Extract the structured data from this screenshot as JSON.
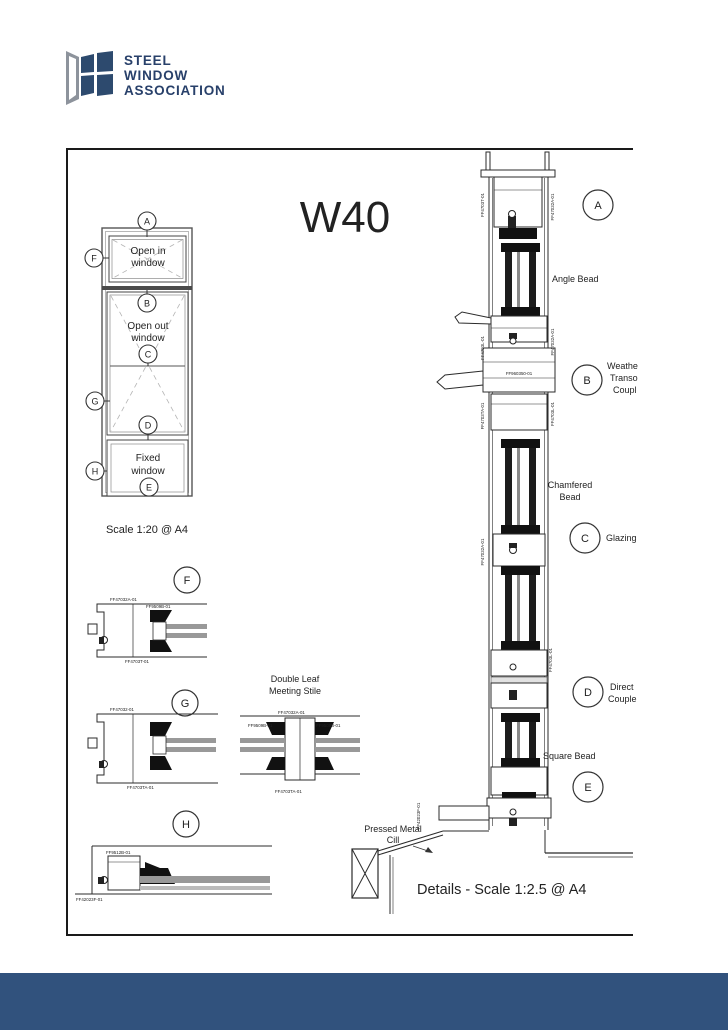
{
  "logo": {
    "line1": "STEEL",
    "line2": "WINDOW",
    "line3": "ASSOCIATION"
  },
  "sheet": {
    "title": "W40",
    "elevation": {
      "open_in_1": "Open in",
      "open_in_2": "window",
      "open_out_1": "Open out",
      "open_out_2": "window",
      "fixed_1": "Fixed",
      "fixed_2": "window",
      "scale": "Scale 1:20 @ A4"
    },
    "markers": {
      "a": "A",
      "b": "B",
      "c": "C",
      "d": "D",
      "e": "E",
      "f": "F",
      "g": "G",
      "h": "H"
    },
    "annotations": {
      "angle_bead": "Angle Bead",
      "weathered_l1": "Weathe",
      "weathered_l2": "Transo",
      "weathered_l3": "Coupl",
      "chamfered_l1": "Chamfered",
      "chamfered_l2": "Bead",
      "glazing": "Glazing",
      "direct_l1": "Direct",
      "direct_l2": "Couple",
      "square_bead": "Square Bead",
      "pressed_l1": "Pressed Metal",
      "pressed_l2": "Cill",
      "double_leaf_l1": "Double Leaf",
      "double_leaf_l2": "Meeting Stile",
      "details_scale": "Details - Scale 1:2.5 @ A4"
    },
    "parts": {
      "ff4703t": "FF4703T-01",
      "ff47032a": "FF47032A-01",
      "ff47032": "FF47032-01",
      "ff4703l": "FF4703L-01",
      "ff4703ta": "FF4703TA-01",
      "ff9509b": "FF9509B-01",
      "ff960350": "FF960350-01",
      "ff9512b": "FF9512B-01",
      "ff42023f": "FF42023F-01"
    },
    "colors": {
      "brand": "#2d4a6e",
      "footer": "#31527d"
    }
  }
}
